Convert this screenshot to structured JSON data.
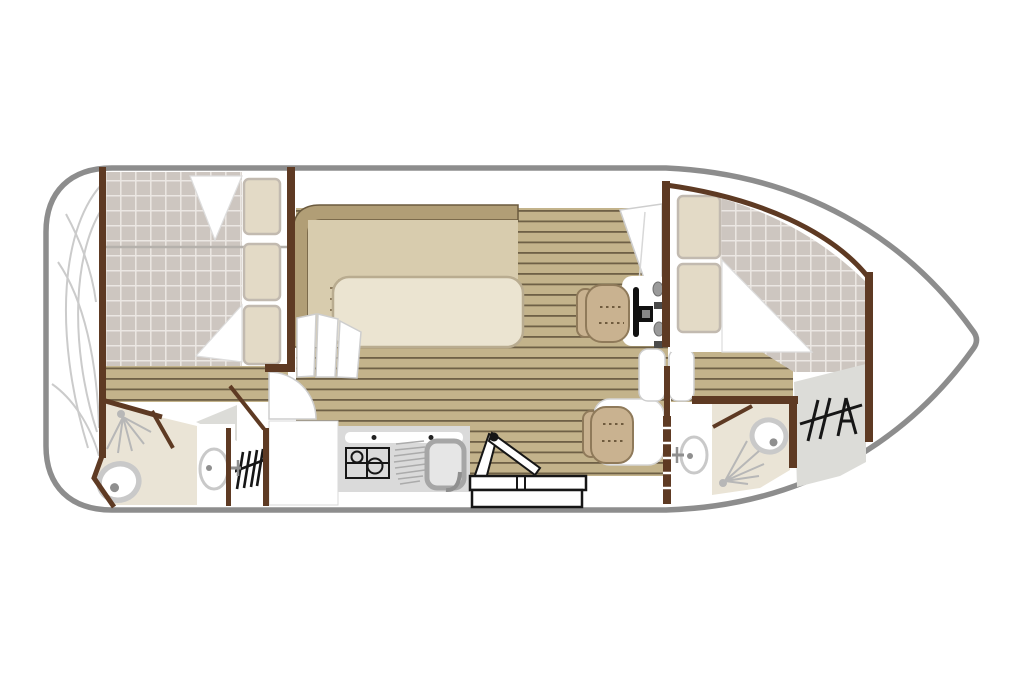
{
  "page": {
    "description": "Deck floor plan of a canal cruising boat, bow pointing right, no visible text labels"
  },
  "colors": {
    "hull-stroke": "#8d8d8d",
    "wall": "#5e3a23",
    "checker-base": "#cdc6c0",
    "checker-line": "#ebe7e3",
    "plank-base": "#c3b38b",
    "plank-line": "#6e6046",
    "bench-band": "#b19e76",
    "bench-seat": "#d8ccae",
    "bench-edge": "#6b5a3e",
    "table-fill": "#ebe4d1",
    "table-edge": "#b9ac90",
    "cream-floor": "#eae4d6",
    "pillow-fill": "#e3dac6",
    "pillow-edge": "#c2bab0",
    "seat-tan": "#c9b290",
    "seat-edge": "#8f7a5a",
    "seat-stitch": "#6f5b3e",
    "gray-floor": "#dcdcd8",
    "galley-gray": "#dadada",
    "fixture-ring": "#c9c9c9",
    "fixture-dark": "#8f8f8f",
    "icon-stroke": "#161616",
    "deck-arc": "#cbcbcb",
    "panel-edge": "#cecece",
    "divider": "#b5b1ac",
    "white": "#ffffff"
  },
  "floorplan": {
    "type": "boat-deck-plan",
    "orientation": "bow-right",
    "areas": [
      {
        "id": "stern-deck",
        "name": "stern deck",
        "fixtures": [
          "deck-curve-lines"
        ]
      },
      {
        "id": "aft-cabin",
        "name": "aft cabin",
        "fixtures": [
          "double-berth",
          "checkered-bedding",
          "pillow",
          "pillow",
          "pillow",
          "folded-duvet",
          "folded-duvet"
        ]
      },
      {
        "id": "aft-bathroom",
        "name": "aft bathroom",
        "fixtures": [
          "shower",
          "toilet",
          "washbasin",
          "door-leaf"
        ]
      },
      {
        "id": "saloon",
        "name": "saloon",
        "fixtures": [
          "l-shaped-sofa",
          "dining-table",
          "companionway-panels",
          "plank-floor"
        ]
      },
      {
        "id": "galley",
        "name": "galley",
        "fixtures": [
          "refrigerator",
          "two-burner-stove",
          "sink",
          "drainboard",
          "folding-table",
          "folding-chair",
          "door-swing"
        ]
      },
      {
        "id": "helm",
        "name": "helm station",
        "fixtures": [
          "pilot-seat",
          "steering-wheel",
          "console",
          "throttle-controls"
        ]
      },
      {
        "id": "dinette",
        "name": "dinette seat",
        "fixtures": [
          "seat",
          "side-berth"
        ]
      },
      {
        "id": "mid-door",
        "name": "sliding double door",
        "fixtures": [
          "door-panel",
          "door-panel"
        ]
      },
      {
        "id": "bow-cabin",
        "name": "bow cabin",
        "fixtures": [
          "double-berth",
          "checkered-bedding",
          "pillow",
          "pillow",
          "folded-duvet"
        ]
      },
      {
        "id": "bow-bathroom",
        "name": "bow bathroom",
        "fixtures": [
          "shower",
          "toilet",
          "washbasin",
          "door-leaf"
        ]
      },
      {
        "id": "port-steps",
        "name": "port side steps landing",
        "fixtures": [
          "stairs-symbol"
        ]
      },
      {
        "id": "bow-steps",
        "name": "bow steps landing",
        "fixtures": [
          "stairs-symbol"
        ]
      },
      {
        "id": "bow-deck",
        "name": "bow deck",
        "fixtures": []
      }
    ]
  }
}
